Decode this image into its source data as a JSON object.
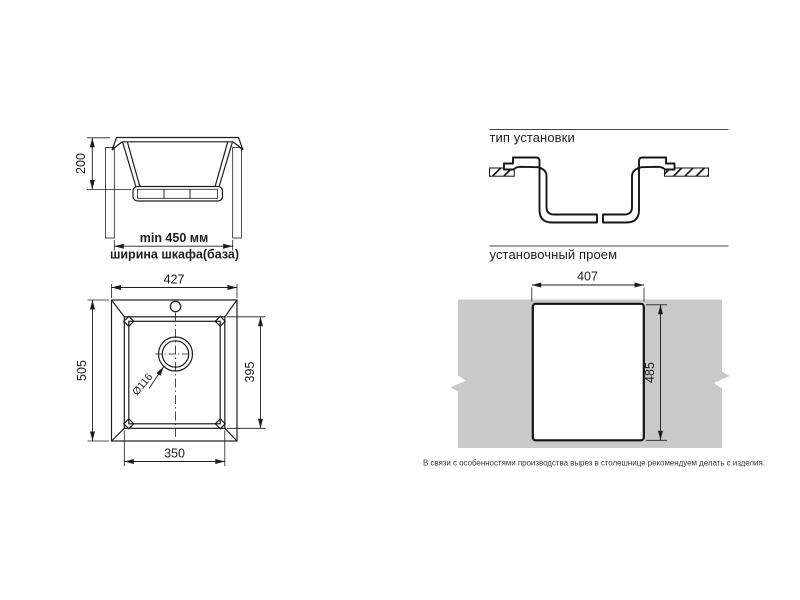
{
  "cross_section": {
    "depth": "200",
    "min_width": "min 450 мм",
    "cabinet_width": "ширина шкафа(база)"
  },
  "installation_type": {
    "header": "тип установки"
  },
  "top_view": {
    "overall_width": "427",
    "overall_depth": "505",
    "bowl_depth": "395",
    "bowl_width": "350",
    "drain_diameter": "Ø116"
  },
  "opening": {
    "header": "установочный проем",
    "cutout_width": "407",
    "cutout_height": "485",
    "note": "В связи с особенностями производства вырез в столешнице рекомендуем делать с изделия."
  },
  "colors": {
    "line": "#1d1d1b",
    "countertop_gray": "#c9c9c9"
  }
}
